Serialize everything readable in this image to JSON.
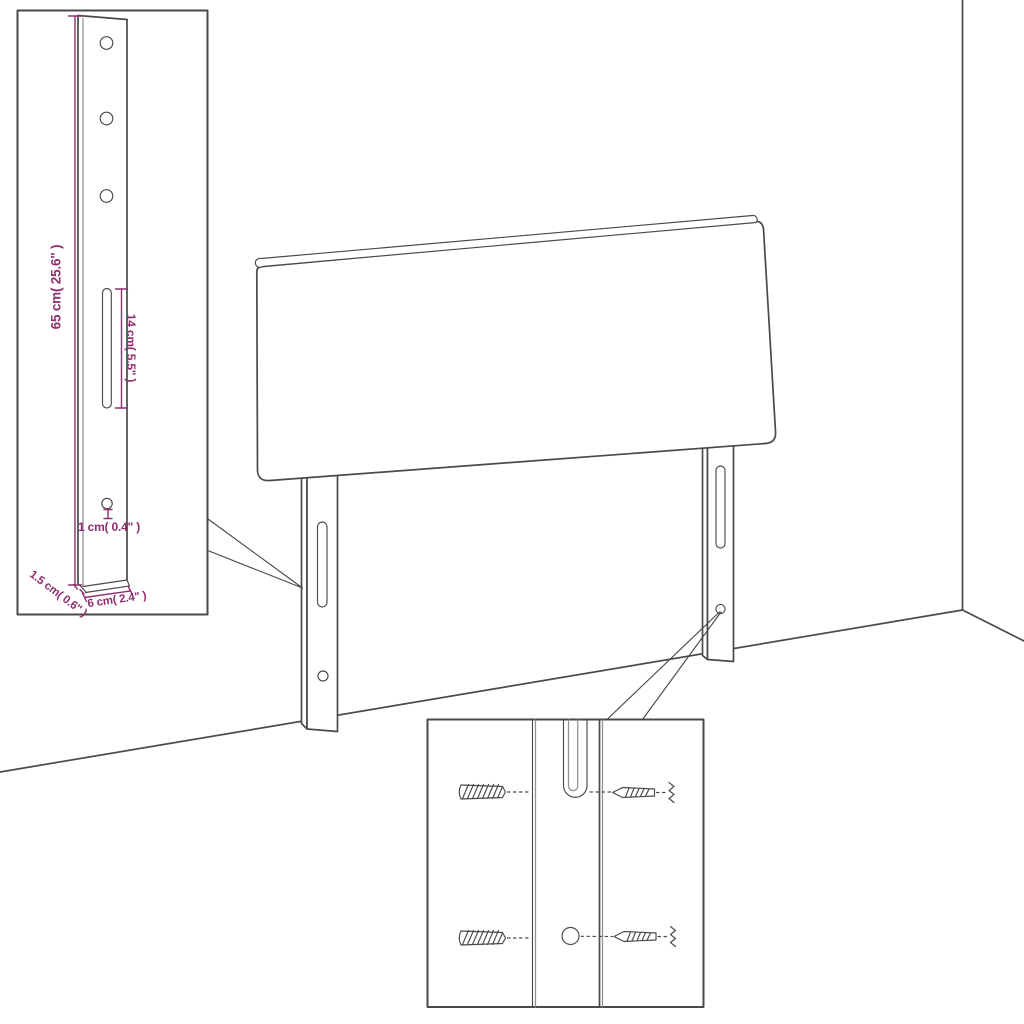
{
  "colors": {
    "background": "#ffffff",
    "line": "#4a4a4a",
    "line_light": "#909090",
    "dimension": "#8e2f6e"
  },
  "inset_leg_detail": {
    "labels": {
      "height": "65 cm( 25.6\" )",
      "slot_length": "14 cm( 5.5\" )",
      "hole_diameter": "1 cm( 0.4\" )",
      "thickness": "1.5 cm( 0.6\" )",
      "width": "6 cm( 2.4\" )"
    }
  }
}
